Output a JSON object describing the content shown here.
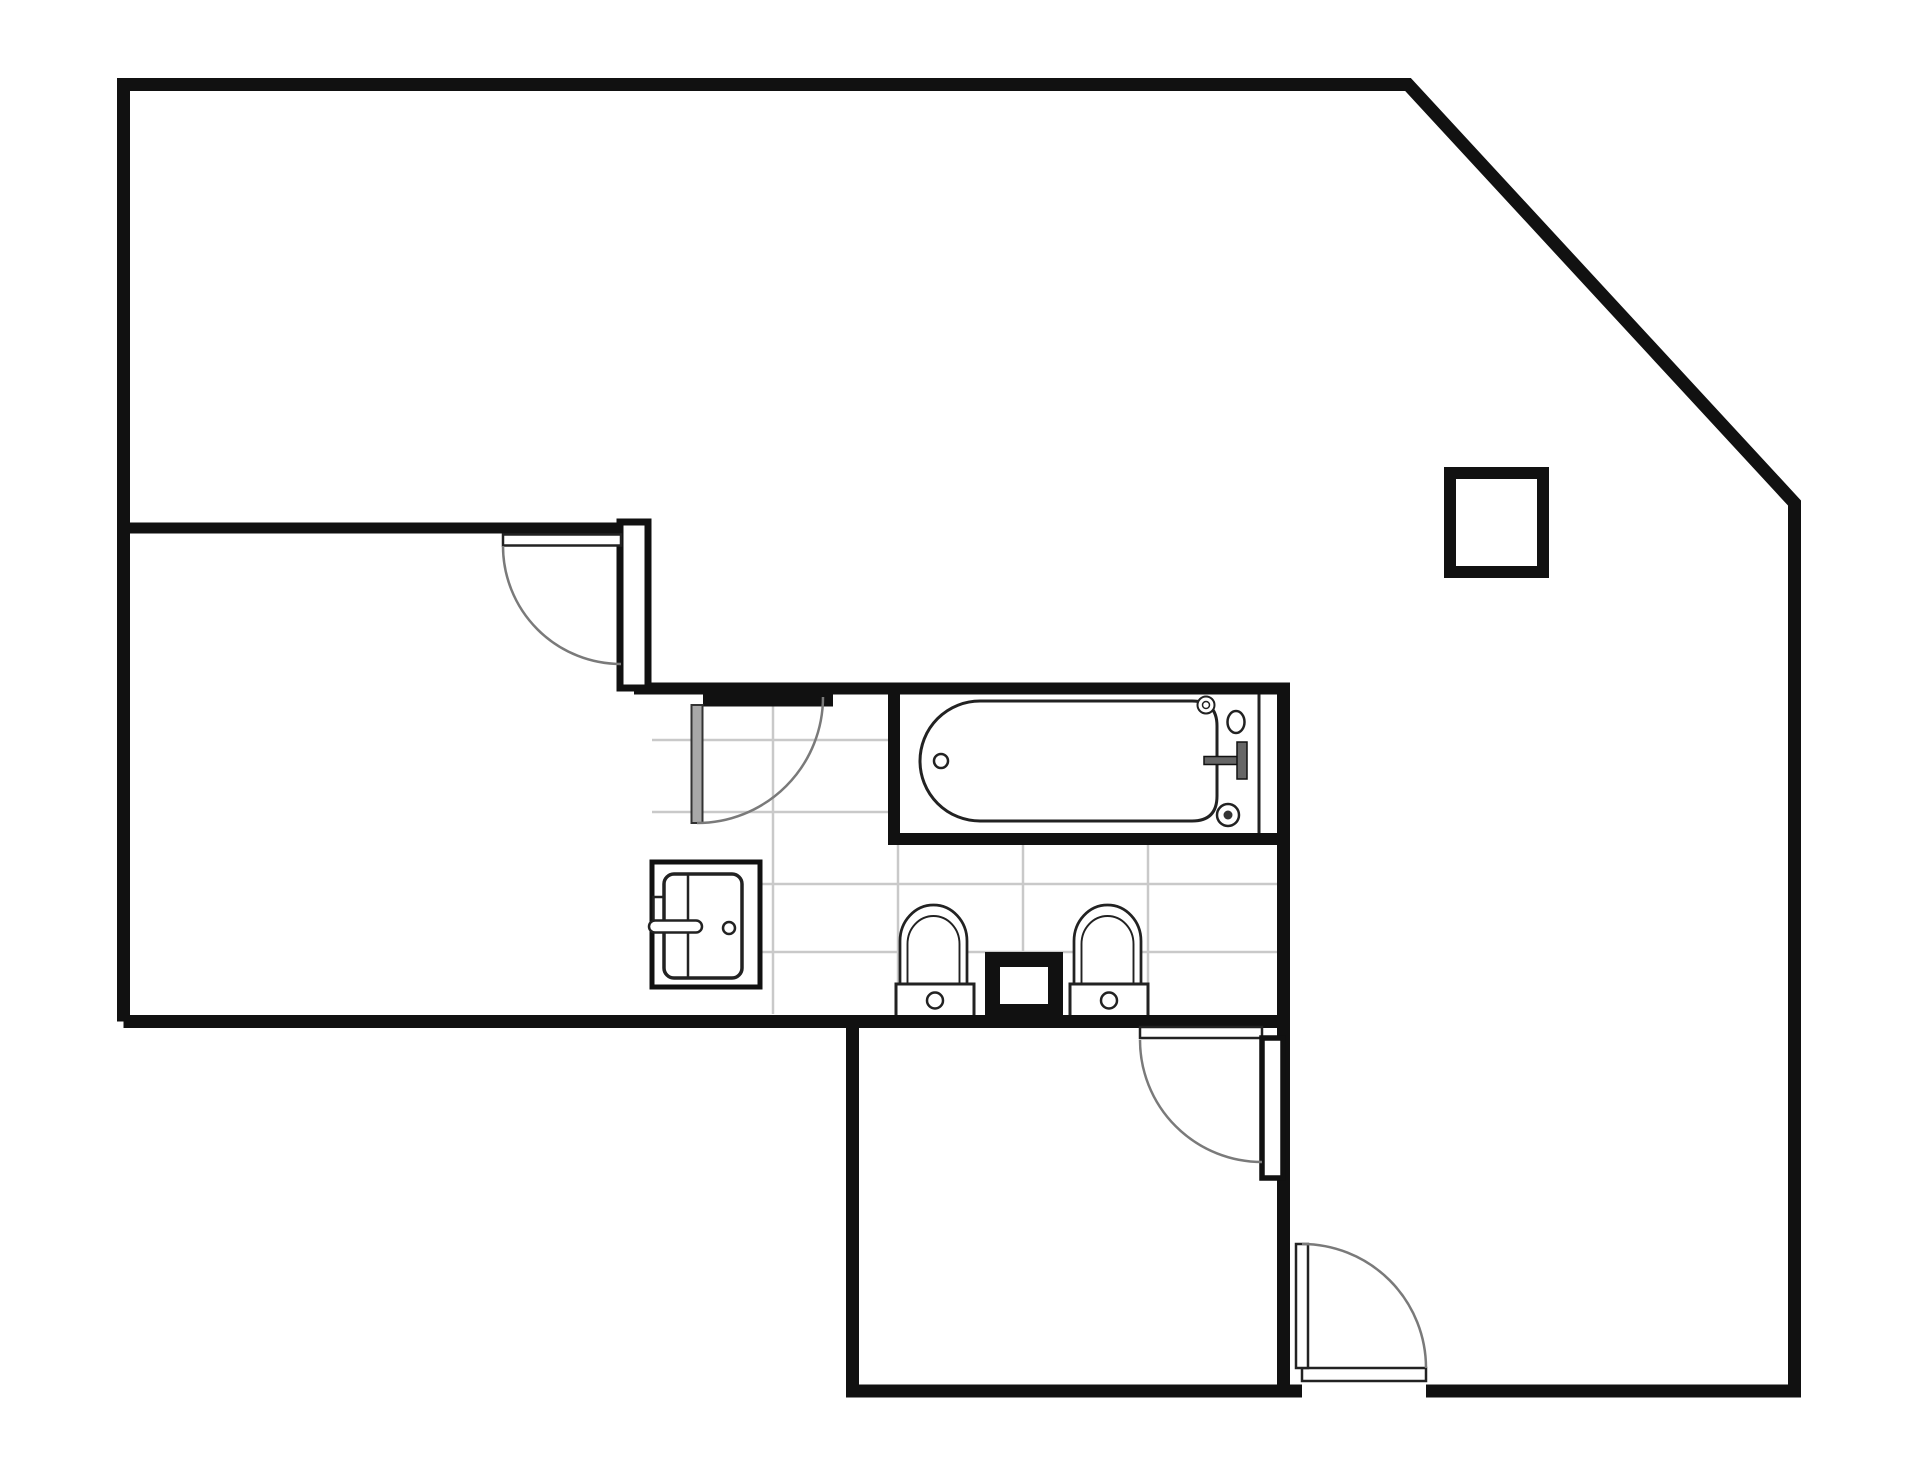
{
  "document": {
    "kind": "architectural-floor-plan",
    "background": "#ffffff",
    "canvas": {
      "width": 1920,
      "height": 1461
    }
  },
  "palette": {
    "wall": "#111111",
    "fixture": "#222222",
    "door_arc": "#7a7a7a",
    "door_leaf_fill": "#a8a8a8",
    "tile": "#c9c9c9",
    "white": "#ffffff",
    "handle_fill": "#666666"
  },
  "tile_grid": {
    "bounds": {
      "x1": 652,
      "y1": 695,
      "x2": 1277,
      "y2": 1014
    },
    "vertical_lines_x": [
      773,
      898,
      1023,
      1148
    ],
    "horizontal_lines_y": [
      740,
      812,
      884,
      952
    ],
    "stroke_width": 2.5
  },
  "shapes": [
    {
      "name": "tub-interior-floor",
      "kind": "rect",
      "x": 900,
      "y": 694,
      "w": 377,
      "h": 139,
      "fill": "#ffffff"
    },
    {
      "name": "bathtub-body",
      "kind": "path",
      "d": "M 980 701 L 1192 701 Q 1217 701 1217 726 L 1217 796 Q 1217 821 1192 821 L 980 821 A 60 60 0 0 1 980 701 Z",
      "stroke": "#222222",
      "sw": 3,
      "fill": "#ffffff"
    },
    {
      "name": "bathtub-drain",
      "kind": "circle",
      "cx": 941,
      "cy": 761,
      "r": 7,
      "stroke": "#222222",
      "sw": 2.5,
      "fill": "#ffffff"
    },
    {
      "name": "bathtub-tap-top",
      "kind": "circle",
      "cx": 1206,
      "cy": 705,
      "r": 8.5,
      "stroke": "#222222",
      "sw": 2,
      "fill": "#ffffff"
    },
    {
      "name": "bathtub-tap-top-dot",
      "kind": "circle",
      "cx": 1206,
      "cy": 705,
      "r": 3.5,
      "stroke": "#222222",
      "sw": 1.5,
      "fill": "#ffffff"
    },
    {
      "name": "bathtub-spout",
      "kind": "ellipse",
      "cx": 1236,
      "cy": 722,
      "rx": 8.5,
      "ry": 11,
      "stroke": "#222222",
      "sw": 2.5,
      "fill": "#ffffff"
    },
    {
      "name": "bathtub-handle-stem",
      "kind": "rect",
      "x": 1204,
      "y": 756.5,
      "w": 36,
      "h": 8,
      "fill": "#666666",
      "stroke": "#111111",
      "sw": 1.5
    },
    {
      "name": "bathtub-handle-bar",
      "kind": "rect",
      "x": 1237,
      "y": 742,
      "w": 10,
      "h": 37,
      "fill": "#666666",
      "stroke": "#111111",
      "sw": 1.5
    },
    {
      "name": "bathtub-tap-bottom",
      "kind": "circle",
      "cx": 1228,
      "cy": 815,
      "r": 11,
      "stroke": "#222222",
      "sw": 2.5,
      "fill": "#ffffff"
    },
    {
      "name": "bathtub-tap-bottom-dot",
      "kind": "circle",
      "cx": 1228,
      "cy": 815,
      "r": 4.5,
      "fill": "#333333"
    },
    {
      "name": "sink-cabinet",
      "kind": "rect",
      "x": 652,
      "y": 862,
      "w": 108,
      "h": 125,
      "fill": "#ffffff",
      "stroke": "#111111",
      "sw": 5
    },
    {
      "name": "sink-basin",
      "kind": "rect",
      "x": 664,
      "y": 874,
      "w": 78,
      "h": 104,
      "rx": 10,
      "fill": "#ffffff",
      "stroke": "#222222",
      "sw": 3.5
    },
    {
      "name": "sink-divider",
      "kind": "line",
      "x1": 688,
      "y1": 874,
      "x2": 688,
      "y2": 978,
      "stroke": "#222222",
      "sw": 2.5
    },
    {
      "name": "sink-faucet-stub",
      "kind": "rect",
      "x": 653.5,
      "y": 897,
      "w": 10,
      "h": 26,
      "fill": "#ffffff",
      "stroke": "#222222",
      "sw": 2.5
    },
    {
      "name": "sink-faucet-bar",
      "kind": "rect",
      "x": 649,
      "y": 920.5,
      "w": 53,
      "h": 12,
      "rx": 6,
      "fill": "#ffffff",
      "stroke": "#222222",
      "sw": 2.5
    },
    {
      "name": "sink-drain",
      "kind": "circle",
      "cx": 729,
      "cy": 928,
      "r": 6,
      "stroke": "#222222",
      "sw": 2.5,
      "fill": "#ffffff"
    },
    {
      "name": "toilet-1-bowl-outer",
      "kind": "path",
      "d": "M 900 985 L 900 941 A 33.5 36 0 0 1 967 941 L 967 985",
      "stroke": "#222222",
      "sw": 2.75,
      "fill": "#ffffff"
    },
    {
      "name": "toilet-1-bowl-inner",
      "kind": "path",
      "d": "M 907.5 985 L 907.5 944 A 26 28 0 0 1 959.5 944 L 959.5 985",
      "stroke": "#222222",
      "sw": 1.9,
      "fill": "none"
    },
    {
      "name": "toilet-1-tank",
      "kind": "rect",
      "x": 896,
      "y": 984,
      "w": 78,
      "h": 33,
      "fill": "#ffffff",
      "stroke": "#222222",
      "sw": 3
    },
    {
      "name": "toilet-1-button",
      "kind": "circle",
      "cx": 935,
      "cy": 1000.5,
      "r": 8,
      "stroke": "#222222",
      "sw": 2.5,
      "fill": "#ffffff"
    },
    {
      "name": "duct-shaft-outer",
      "kind": "rect",
      "x": 985,
      "y": 952,
      "w": 78,
      "h": 65,
      "fill": "#111111"
    },
    {
      "name": "duct-shaft-inner",
      "kind": "rect",
      "x": 1000,
      "y": 967,
      "w": 48,
      "h": 37,
      "fill": "#ffffff"
    },
    {
      "name": "toilet-2-bowl-outer",
      "kind": "path",
      "d": "M 1074 985 L 1074 941 A 33.5 36 0 0 1 1141 941 L 1141 985",
      "stroke": "#222222",
      "sw": 2.75,
      "fill": "#ffffff"
    },
    {
      "name": "toilet-2-bowl-inner",
      "kind": "path",
      "d": "M 1081.5 985 L 1081.5 944 A 26 28 0 0 1 1133.5 944 L 1133.5 985",
      "stroke": "#222222",
      "sw": 1.9,
      "fill": "none"
    },
    {
      "name": "toilet-2-tank",
      "kind": "rect",
      "x": 1070,
      "y": 984,
      "w": 78,
      "h": 33,
      "fill": "#ffffff",
      "stroke": "#222222",
      "sw": 3
    },
    {
      "name": "toilet-2-button",
      "kind": "circle",
      "cx": 1109,
      "cy": 1000.5,
      "r": 8,
      "stroke": "#222222",
      "sw": 2.5,
      "fill": "#ffffff"
    },
    {
      "name": "outer-wall-right-section",
      "kind": "path",
      "d": "M 123.5 1021.5 L 123.5 84.5 L 1408 84.5 L 1794.5 503 L 1794.5 1391 L 1426 1391",
      "stroke": "#111111",
      "sw": 13,
      "fill": "none"
    },
    {
      "name": "outer-wall-left-section",
      "kind": "path",
      "d": "M 1302 1391 L 852.5 1391 L 852.5 1021.5 L 123.5 1021.5",
      "stroke": "#111111",
      "sw": 13,
      "fill": "none"
    },
    {
      "name": "divider-wall-bathroom-bottom",
      "kind": "line",
      "x1": 846,
      "y1": 1021.5,
      "x2": 1283,
      "y2": 1021.5,
      "stroke": "#111111",
      "sw": 13
    },
    {
      "name": "left-room-top-wall",
      "kind": "line",
      "x1": 123,
      "y1": 528,
      "x2": 648,
      "y2": 528,
      "stroke": "#111111",
      "sw": 11
    },
    {
      "name": "bathroom-top-wall",
      "kind": "line",
      "x1": 634,
      "y1": 688.5,
      "x2": 1290,
      "y2": 688.5,
      "stroke": "#111111",
      "sw": 12
    },
    {
      "name": "bathroom-door-header",
      "kind": "rect",
      "x": 703,
      "y": 694.5,
      "w": 130,
      "h": 12,
      "fill": "#111111"
    },
    {
      "name": "tub-left-wall",
      "kind": "line",
      "x1": 894,
      "y1": 688,
      "x2": 894,
      "y2": 840,
      "stroke": "#111111",
      "sw": 12
    },
    {
      "name": "tub-bottom-wall",
      "kind": "line",
      "x1": 888,
      "y1": 839,
      "x2": 1290,
      "y2": 839,
      "stroke": "#111111",
      "sw": 12
    },
    {
      "name": "right-interior-wall",
      "kind": "line",
      "x1": 1283.5,
      "y1": 683,
      "x2": 1283.5,
      "y2": 1391,
      "stroke": "#111111",
      "sw": 13
    },
    {
      "name": "tub-platform-line",
      "kind": "line",
      "x1": 1259,
      "y1": 694.5,
      "x2": 1259,
      "y2": 833,
      "stroke": "#222222",
      "sw": 3
    },
    {
      "name": "door-jamb-frame",
      "kind": "rect",
      "x": 620,
      "y": 522,
      "w": 28,
      "h": 166,
      "fill": "#ffffff",
      "stroke": "#111111",
      "sw": 7
    },
    {
      "name": "left-room-door-leaf",
      "kind": "rect",
      "x": 503,
      "y": 534.5,
      "w": 118,
      "h": 11,
      "fill": "#ffffff",
      "stroke": "#222222",
      "sw": 2.5
    },
    {
      "name": "left-room-door-arc",
      "kind": "path",
      "d": "M 503 546 A 118 118 0 0 0 621 664",
      "stroke": "#7a7a7a",
      "sw": 2.5,
      "fill": "none"
    },
    {
      "name": "bathroom-door-leaf",
      "kind": "rect",
      "x": 691.5,
      "y": 705,
      "w": 11,
      "h": 118,
      "fill": "#a8a8a8",
      "stroke": "#333333",
      "sw": 2
    },
    {
      "name": "bathroom-door-arc",
      "kind": "path",
      "d": "M 697 823 A 126 126 0 0 0 823 697",
      "stroke": "#7a7a7a",
      "sw": 2.5,
      "fill": "none"
    },
    {
      "name": "bottom-room-door-leaf",
      "kind": "rect",
      "x": 1140,
      "y": 1027,
      "w": 122,
      "h": 11,
      "fill": "#ffffff",
      "stroke": "#222222",
      "sw": 2.5
    },
    {
      "name": "bottom-room-door-frame",
      "kind": "rect",
      "x": 1262,
      "y": 1038,
      "w": 21,
      "h": 140,
      "fill": "#ffffff",
      "stroke": "#111111",
      "sw": 5.5
    },
    {
      "name": "bottom-room-door-arc",
      "kind": "path",
      "d": "M 1140 1040 A 122 122 0 0 0 1262 1162",
      "stroke": "#7a7a7a",
      "sw": 2.5,
      "fill": "none"
    },
    {
      "name": "entry-door-header",
      "kind": "rect",
      "x": 1302,
      "y": 1368,
      "w": 124,
      "h": 13,
      "fill": "#ffffff",
      "stroke": "#222222",
      "sw": 2.5
    },
    {
      "name": "entry-door-leaf",
      "kind": "rect",
      "x": 1296,
      "y": 1244,
      "w": 12,
      "h": 124,
      "fill": "#ffffff",
      "stroke": "#222222",
      "sw": 2.5
    },
    {
      "name": "entry-door-arc",
      "kind": "path",
      "d": "M 1302 1244 A 124 124 0 0 1 1426 1368",
      "stroke": "#7a7a7a",
      "sw": 2.5,
      "fill": "none"
    },
    {
      "name": "column-square",
      "kind": "rect",
      "x": 1450,
      "y": 473,
      "w": 93,
      "h": 99,
      "fill": "#ffffff",
      "stroke": "#111111",
      "sw": 12
    }
  ]
}
